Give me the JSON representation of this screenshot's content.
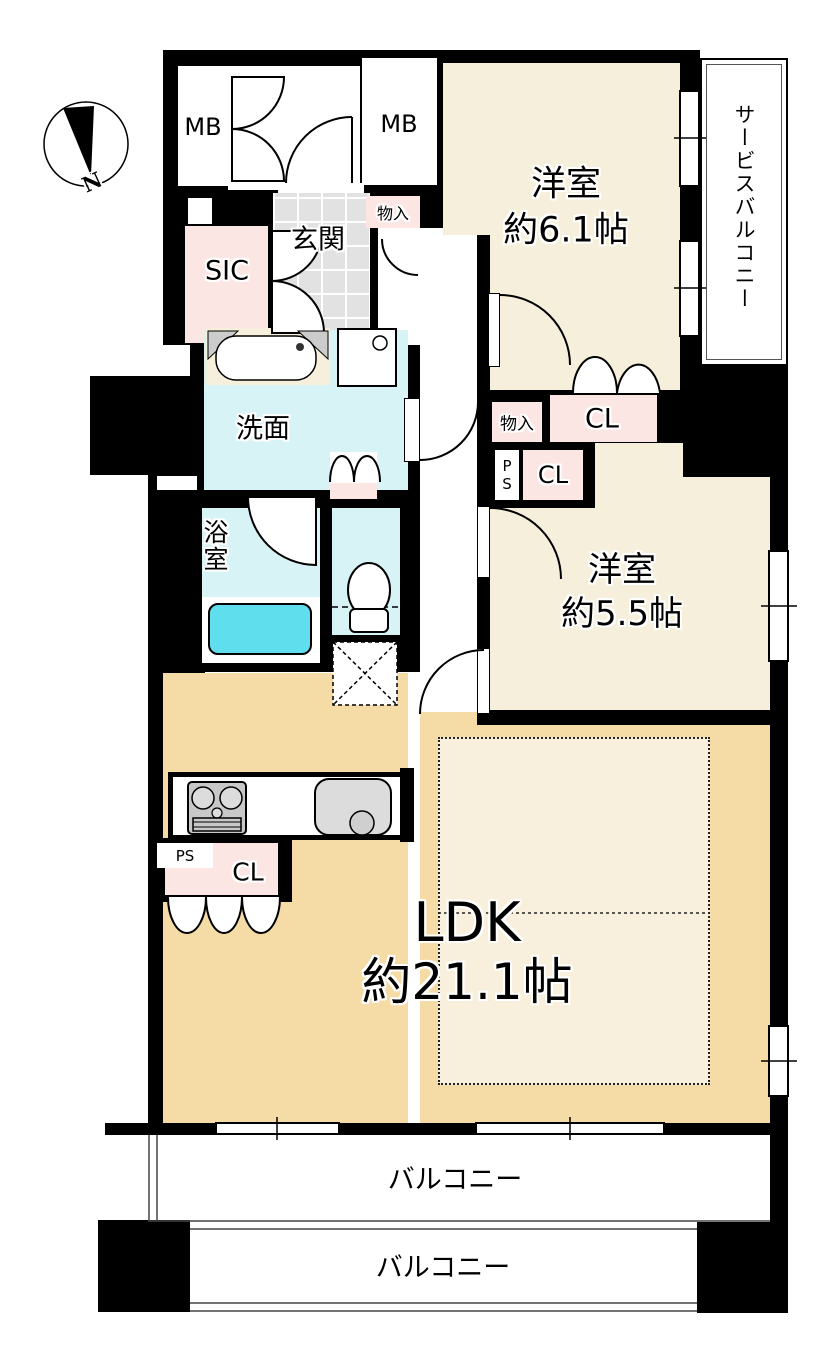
{
  "floorplan": {
    "compass": {
      "north_label": "N"
    },
    "labels": {
      "meter_box_left": "MB",
      "meter_box_right": "MB",
      "entrance": "玄関",
      "entrance_storage": "物入",
      "shoe_closet": "SIC",
      "bedroom1_name": "洋室",
      "bedroom1_size": "約6.1帖",
      "service_balcony": "サービスバルコニー",
      "washroom": "洗面",
      "bathroom": "浴室",
      "mid_storage": "物入",
      "closet_top": "CL",
      "pipe_space_mid": "PS",
      "closet_mid": "CL",
      "bedroom2_name": "洋室",
      "bedroom2_size": "約5.5帖",
      "ldk_name": "LDK",
      "ldk_size": "約21.1帖",
      "pipe_space_kitchen": "PS",
      "closet_kitchen": "CL",
      "balcony_upper": "バルコニー",
      "balcony_lower": "バルコニー"
    },
    "colors": {
      "wall": "#000000",
      "bedroom_floor": "#f6efdb",
      "ldk_floor": "#f5dba5",
      "ldk_inner_zone": "#f8f0dc",
      "wet_area": "#d8f3f5",
      "bathtub": "#5fdeed",
      "closet_pink": "#fce6e4",
      "entrance_tile": "#e2e2e2"
    }
  }
}
